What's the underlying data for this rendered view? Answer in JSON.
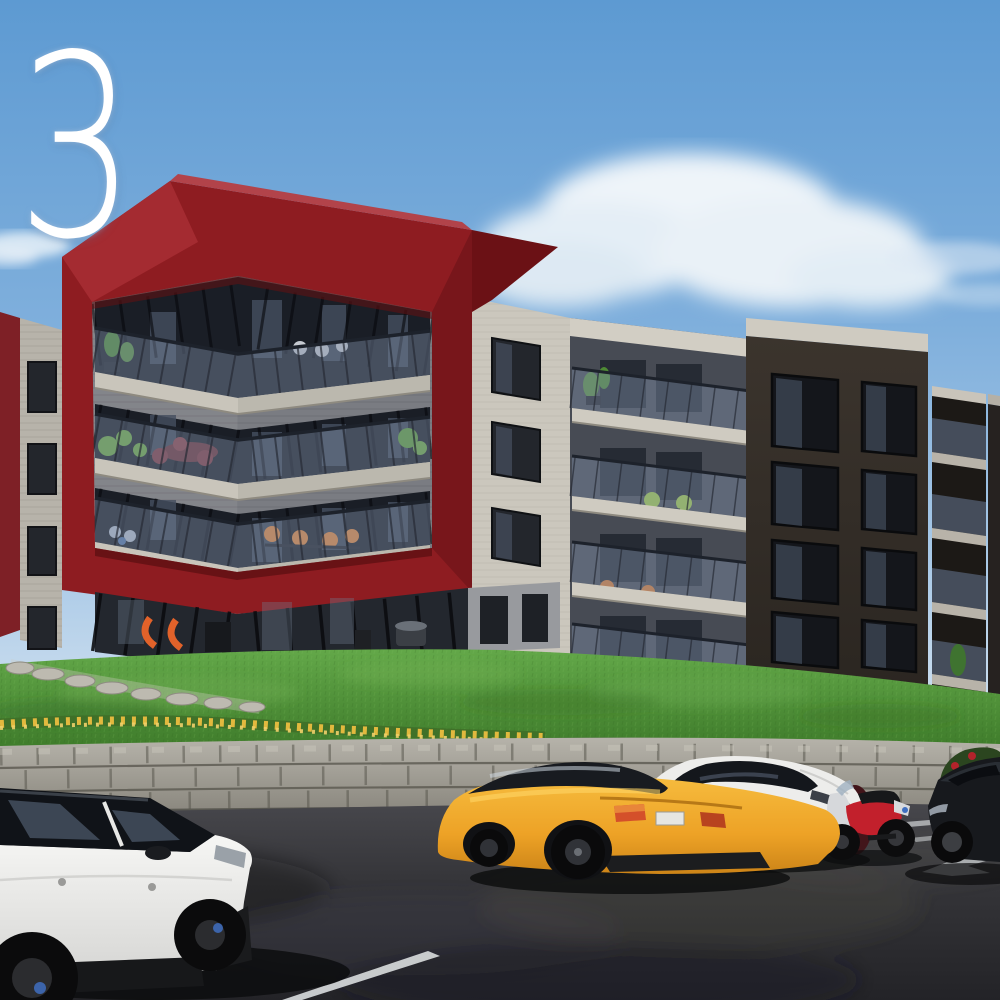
{
  "overlay": {
    "numeral": "3",
    "numeral_color": "#ffffff"
  },
  "scene": {
    "description": "Architectural rendering of a four-storey apartment complex with a dark red frame feature, grass berm, stone retaining wall and parking lot with vehicles",
    "sky": {
      "top_color": "#5d9ad2",
      "horizon_color": "#cfe0ef",
      "cloud_color": "#eef4f9",
      "clouds": [
        "large-cumulus-center-right",
        "wisp-right-edge",
        "small-puff-left"
      ]
    },
    "buildings": {
      "red_frame_block": {
        "frame_color": "#8e1c21",
        "frame_highlight": "#a42b31",
        "frame_shadow": "#6b1115",
        "siding_color": "#83858a",
        "slab_color": "#c9c5bb",
        "balcony_floors": 3,
        "railing": "glass",
        "balcony_items": [
          "potted-plants",
          "white-chairs",
          "red-dining-set",
          "orange-chairs"
        ]
      },
      "left_edge_block": {
        "accent_color": "#7e2026",
        "facade_color": "#b7b3aa",
        "window_count": 4
      },
      "middle_block": {
        "facade_color": "#cbc7bd",
        "fascia_color": "#d2cec4",
        "balcony_floors": 4,
        "balcony_items": [
          "plants",
          "green-chairs",
          "orange-chairs"
        ]
      },
      "dark_block": {
        "facade_color": "#3b342d",
        "fascia_color": "#cfcbc1",
        "window_grid": "2x4",
        "balcony_floors": 4
      }
    },
    "landscape": {
      "grass_color": "#569a3c",
      "stone_path": "stepper-stones-left",
      "wall_color": "#aaa79e",
      "mortar_color": "#5a584f",
      "flower_colors": {
        "yellow": "#e2b93e",
        "red": "#b3232b",
        "purple": "#8a5f9e"
      }
    },
    "parking": {
      "asphalt_color": "#343438",
      "line_color": "#d6d9da",
      "markings": [
        "stall-line-foreground",
        "stall-lines-right",
        "direction-arrow"
      ]
    },
    "vehicles": [
      {
        "name": "white-suv",
        "body_color": "#f2f2f0",
        "roof_color": "#101318",
        "position": "bottom-left",
        "view": "rear-three-quarter"
      },
      {
        "name": "yellow-sports-coupe",
        "body_color": "#f4b232",
        "position": "bottom-center",
        "view": "rear-three-quarter"
      },
      {
        "name": "white-coupe-suv",
        "body_color": "#ededeb",
        "position": "center-right",
        "view": "side"
      },
      {
        "name": "sport-motorcycle",
        "body_color": "#c2202c",
        "position": "right",
        "view": "side"
      },
      {
        "name": "black-sedan",
        "body_color": "#17191d",
        "position": "far-right-edge",
        "view": "front-three-quarter"
      }
    ]
  }
}
